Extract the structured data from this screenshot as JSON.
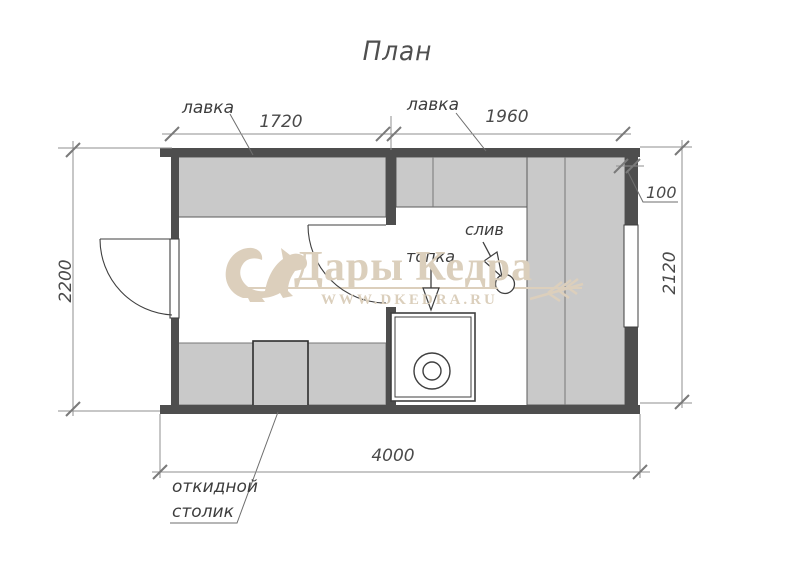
{
  "title": "План",
  "watermark": {
    "brand": "Дары Кедра",
    "url": "WWW.DKEDRA.RU"
  },
  "labels": {
    "bench_left": "лавка",
    "bench_right": "лавка",
    "stove": "топка",
    "drain": "слив",
    "folding_table_line1": "откидной",
    "folding_table_line2": "столик"
  },
  "dimensions": {
    "left_room_width": "1720",
    "right_room_width": "1960",
    "wall_thickness": "100",
    "height_left": "2200",
    "height_right": "2120",
    "total_length": "4000"
  },
  "colors": {
    "wall": "#4e4e4e",
    "bench_fill": "#c9c9c9",
    "watermark": "#dccfbc",
    "object_line": "#3f3f3f",
    "dim_line": "#8f8f8f"
  }
}
